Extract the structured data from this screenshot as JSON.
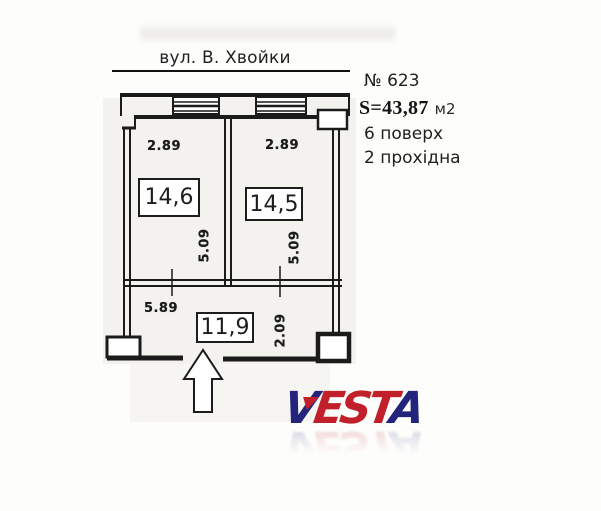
{
  "street_label": "вул. В. Хвойки",
  "listing": {
    "number": "№ 623",
    "area_value": "S=43,87",
    "area_unit": "м2",
    "floor": "6 поверх",
    "layout": "2 прохідна"
  },
  "plan": {
    "room_left": {
      "area": "14,6",
      "width_dim": "2.89",
      "depth_dim": "5.09"
    },
    "room_right": {
      "area": "14,5",
      "width_dim": "2.89",
      "depth_dim": "5.09"
    },
    "room_bottom": {
      "area": "11,9",
      "width_dim": "5.89",
      "depth_dim": "2.09"
    }
  },
  "logo": {
    "name": "VESTA",
    "letters": [
      {
        "char": "V",
        "color": "#24247d"
      },
      {
        "char": "E",
        "color": "#c1202b"
      },
      {
        "char": "S",
        "color": "#c1202b"
      },
      {
        "char": "T",
        "color": "#c1202b"
      },
      {
        "char": "A",
        "color": "#24247d"
      }
    ],
    "navy": "#24247d",
    "red": "#c1202b"
  },
  "colors": {
    "ink": "#1c1c1c",
    "scan_background": "#f3f2ee"
  }
}
